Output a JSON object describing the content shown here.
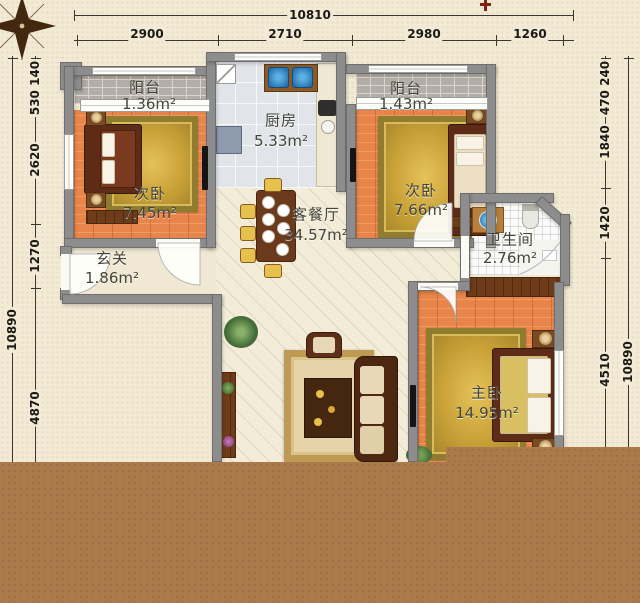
{
  "dimensions": {
    "top": {
      "total": "10810",
      "segments": [
        "2900",
        "2710",
        "2980",
        "1260"
      ]
    },
    "left": {
      "total": "10890",
      "segments": [
        "530",
        "140",
        "2620",
        "1270",
        "4870"
      ]
    },
    "right": {
      "total": "10890",
      "segments": [
        "470",
        "240",
        "1840",
        "1420",
        "4510"
      ]
    }
  },
  "rooms": [
    {
      "name": "阳台",
      "area": "1.36m²"
    },
    {
      "name": "厨房",
      "area": "5.33m²"
    },
    {
      "name": "阳台",
      "area": "1.43m²"
    },
    {
      "name": "次卧",
      "area": "7.45m²"
    },
    {
      "name": "次卧",
      "area": "7.66m²"
    },
    {
      "name": "客餐厅",
      "area": "34.57m²"
    },
    {
      "name": "卫生间",
      "area": "2.76m²"
    },
    {
      "name": "玄关",
      "area": "1.86m²"
    },
    {
      "name": "主卧",
      "area": "14.95m²"
    }
  ],
  "icons": {
    "compass": "compass-rose-icon",
    "north_marker": "red-cross-marker"
  },
  "colors": {
    "wall": "#8d8d8d",
    "wood_floor": "#e8854a",
    "rug_gold": "#c9a238",
    "living_floor": "#f2ecd8",
    "kitchen_floor": "#e1e4e8",
    "bathroom_floor": "#fbfbf7",
    "balcony_floor": "#b2ada6",
    "bottom_band": "#ab7a4a",
    "background": "#f2ead4",
    "dim_text": "#1c1a17"
  }
}
